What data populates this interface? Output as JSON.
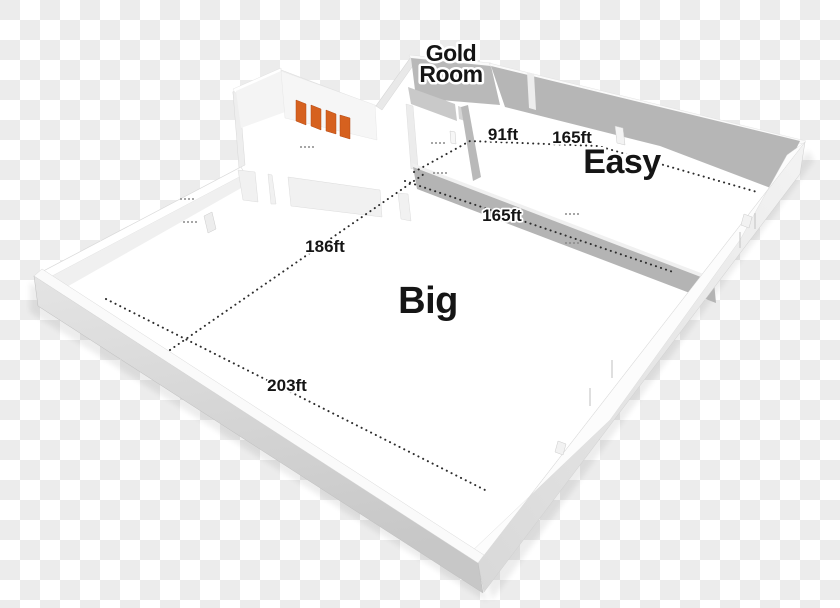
{
  "background": {
    "checker_light": "#ffffff",
    "checker_dark": "#ececec",
    "tile_px": 20
  },
  "palette": {
    "door_orange": "#d6611f",
    "wall_shadow_gray": "#b6b6b6",
    "wall_light": "#f2f2f2",
    "outer_gray": "#c9c9c9",
    "label_ink": "#151515",
    "label_halo": "#ffffff",
    "dotted_line": "#2c2c2c"
  },
  "rooms": [
    {
      "id": "gold-room",
      "lines": [
        "Gold",
        "Room"
      ],
      "x": 451,
      "y": [
        61,
        82
      ],
      "font": 23
    },
    {
      "id": "easy",
      "lines": [
        "Easy"
      ],
      "x": 622,
      "y": [
        173
      ],
      "font": 34
    },
    {
      "id": "big",
      "lines": [
        "Big"
      ],
      "x": 428,
      "y": [
        313
      ],
      "font": 38
    }
  ],
  "dimension_lines": [
    {
      "id": "north-line",
      "points": [
        [
          414,
          172
        ],
        [
          470,
          141
        ],
        [
          598,
          146
        ],
        [
          757,
          192
        ]
      ],
      "labels": [
        {
          "text": "91ft",
          "x": 503,
          "y": 140
        },
        {
          "text": "165ft",
          "x": 572,
          "y": 143
        }
      ]
    },
    {
      "id": "mid-line",
      "points": [
        [
          405,
          181
        ],
        [
          673,
          272
        ]
      ],
      "labels": [
        {
          "text": "165ft",
          "x": 502,
          "y": 221
        }
      ]
    },
    {
      "id": "west-line",
      "points": [
        [
          170,
          350
        ],
        [
          424,
          174
        ]
      ],
      "labels": [
        {
          "text": "186ft",
          "x": 325,
          "y": 252
        }
      ]
    },
    {
      "id": "south-line",
      "points": [
        [
          106,
          299
        ],
        [
          487,
          491
        ]
      ],
      "labels": [
        {
          "text": "203ft",
          "x": 287,
          "y": 391
        }
      ]
    }
  ],
  "gold_doors": {
    "count": 4,
    "color": "#d6611f"
  }
}
